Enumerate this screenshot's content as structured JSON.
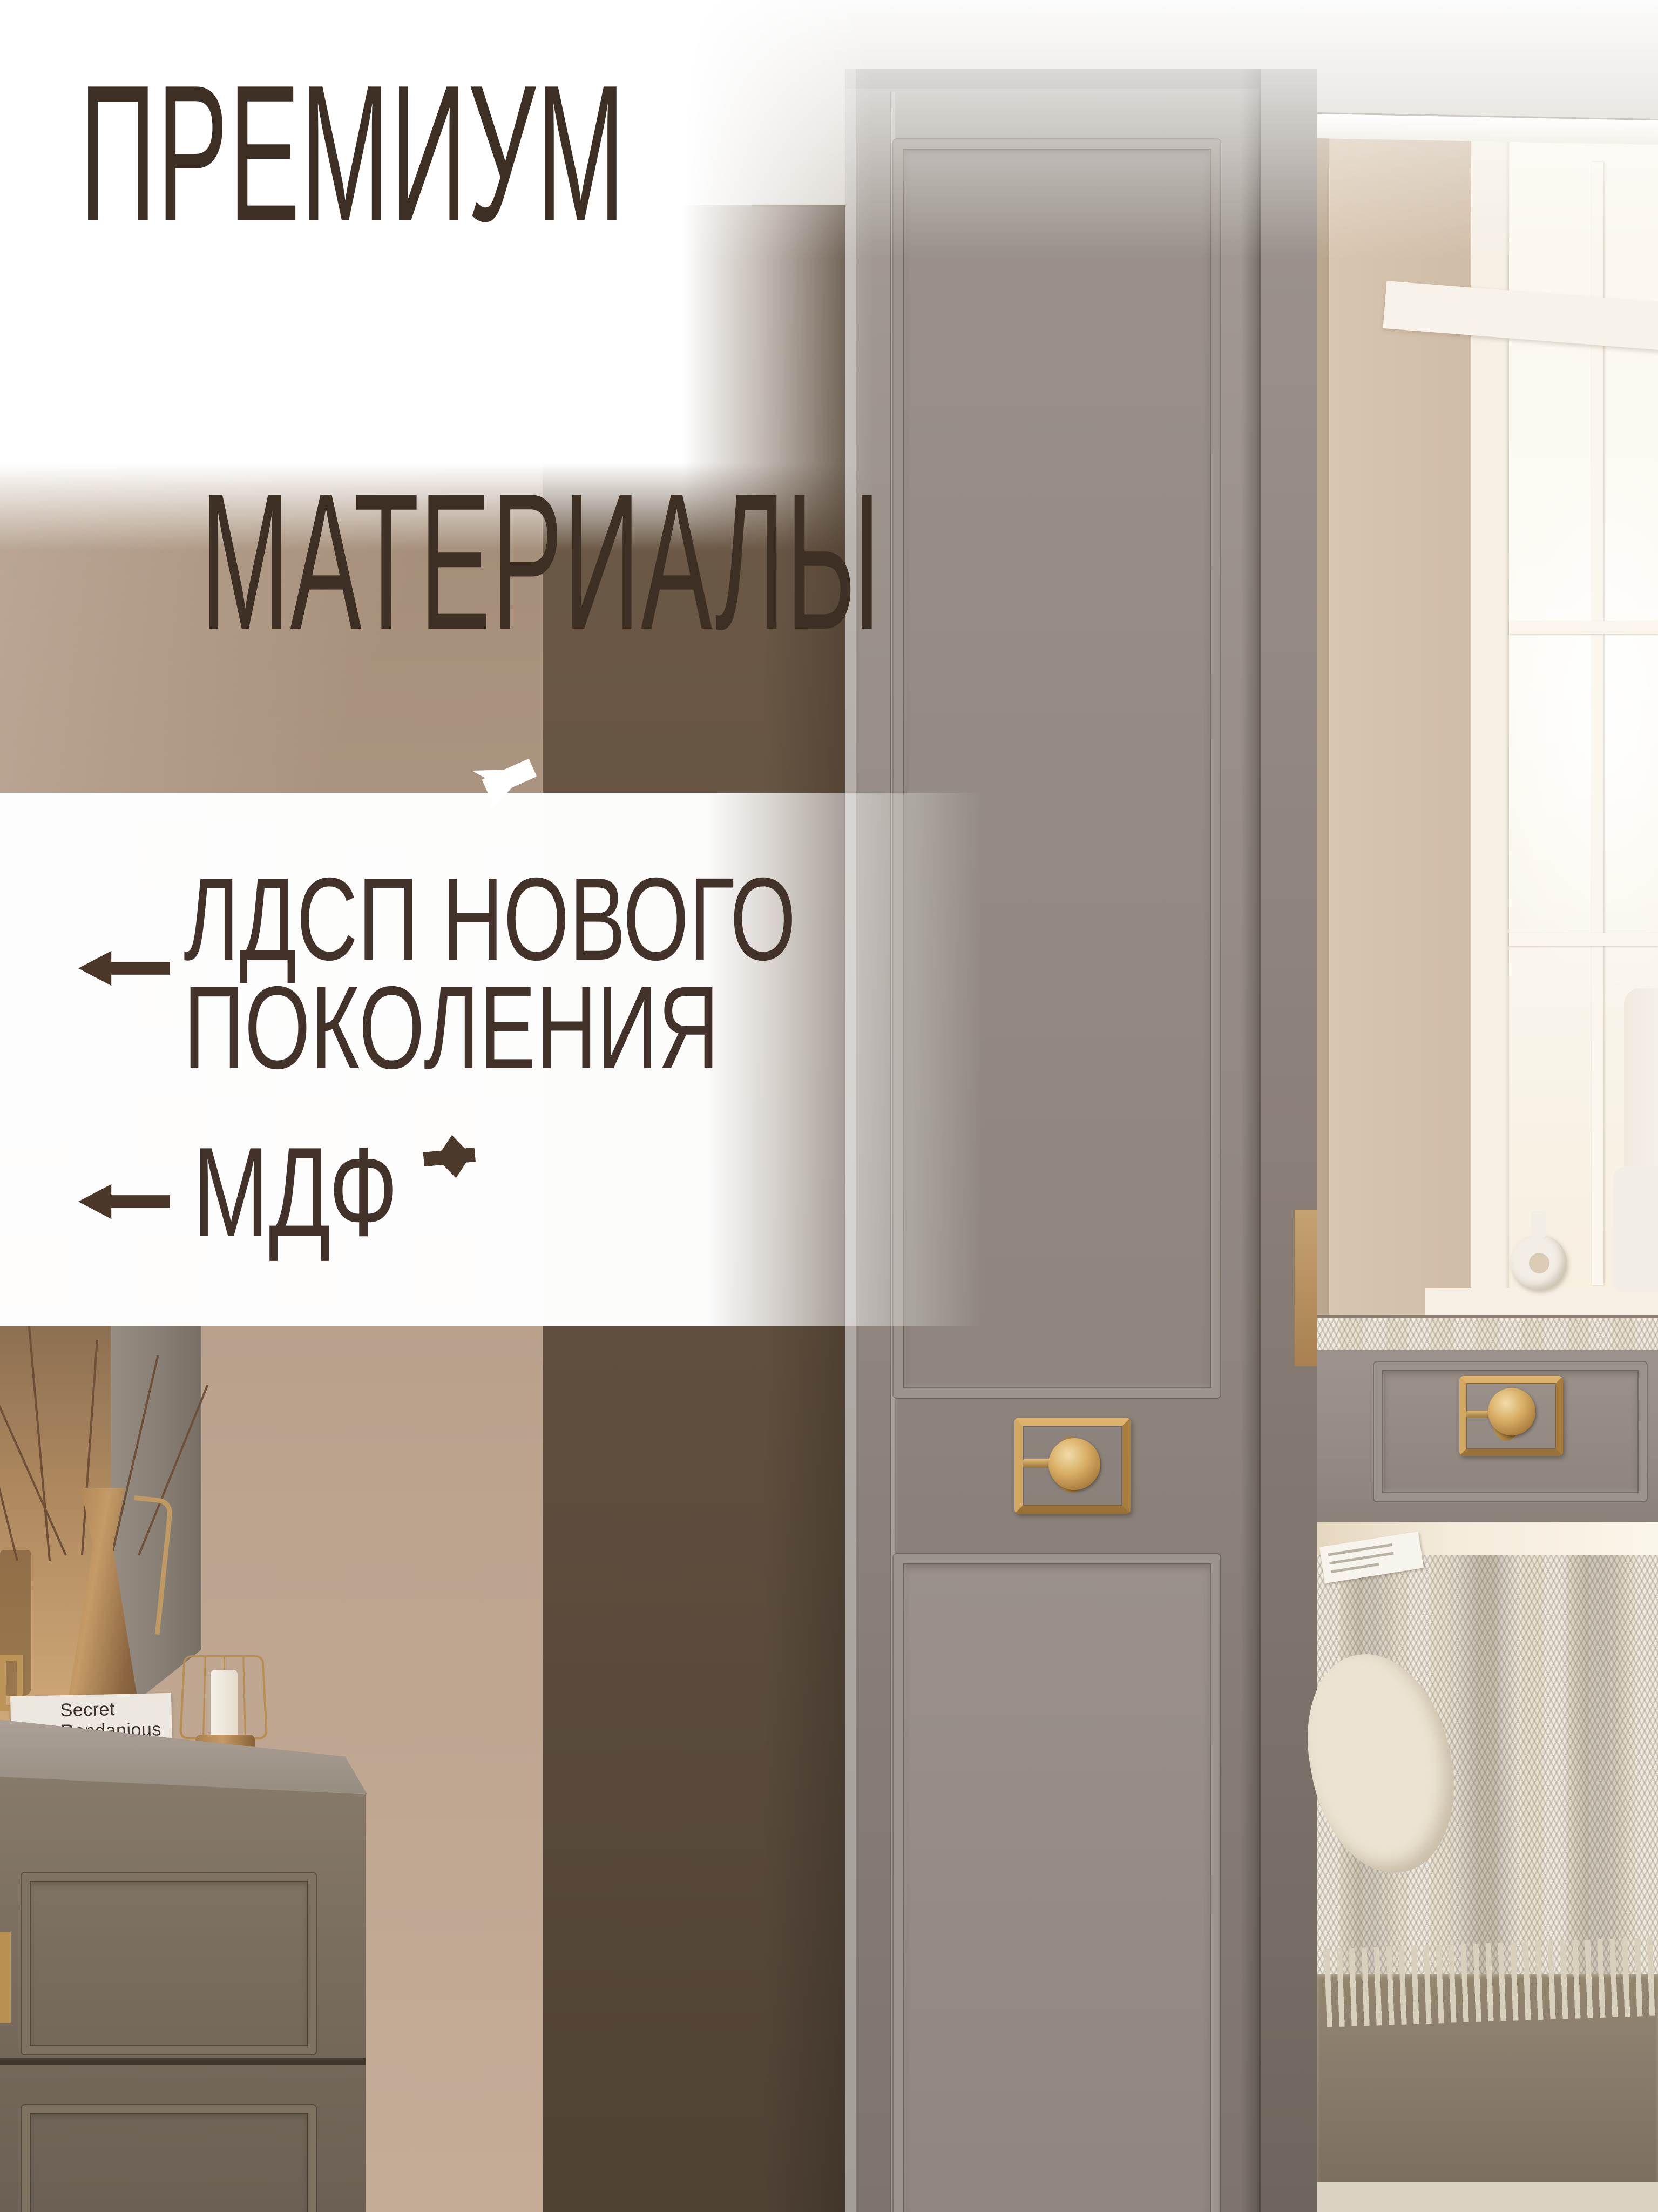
{
  "annotations": {
    "title": {
      "line1": "ПРЕМИУМ",
      "line2": "МАТЕРИАЛЫ"
    },
    "labels": {
      "ldsp": {
        "line1": "ЛДСП НОВОГО",
        "line2": "ПОКОЛЕНИЯ"
      },
      "mdf": {
        "text": "МДФ"
      }
    },
    "colors": {
      "text": "#3e2f25",
      "arrow": "#4a372a",
      "dashed_line": "#4b392b",
      "white_arrow": "#ffffff",
      "overlay": "#ffffff"
    }
  },
  "scene": {
    "decor": {
      "books": [
        {
          "title": "Secret Randanious"
        },
        {
          "title": "TORA NACAH"
        }
      ]
    },
    "palette": {
      "gold_hardware": "#c59a58",
      "wardrobe_gray": "#8e867e",
      "wall_brown": "#a98f79",
      "wall_dark_brown": "#5f4e40",
      "mirror_beige": "#d8c5af",
      "window_light": "#fdfbf4",
      "bed_cream": "#e9e2d3",
      "bed_base_taupe": "#8a7c6d",
      "carpet": "#d9d2c2"
    }
  }
}
